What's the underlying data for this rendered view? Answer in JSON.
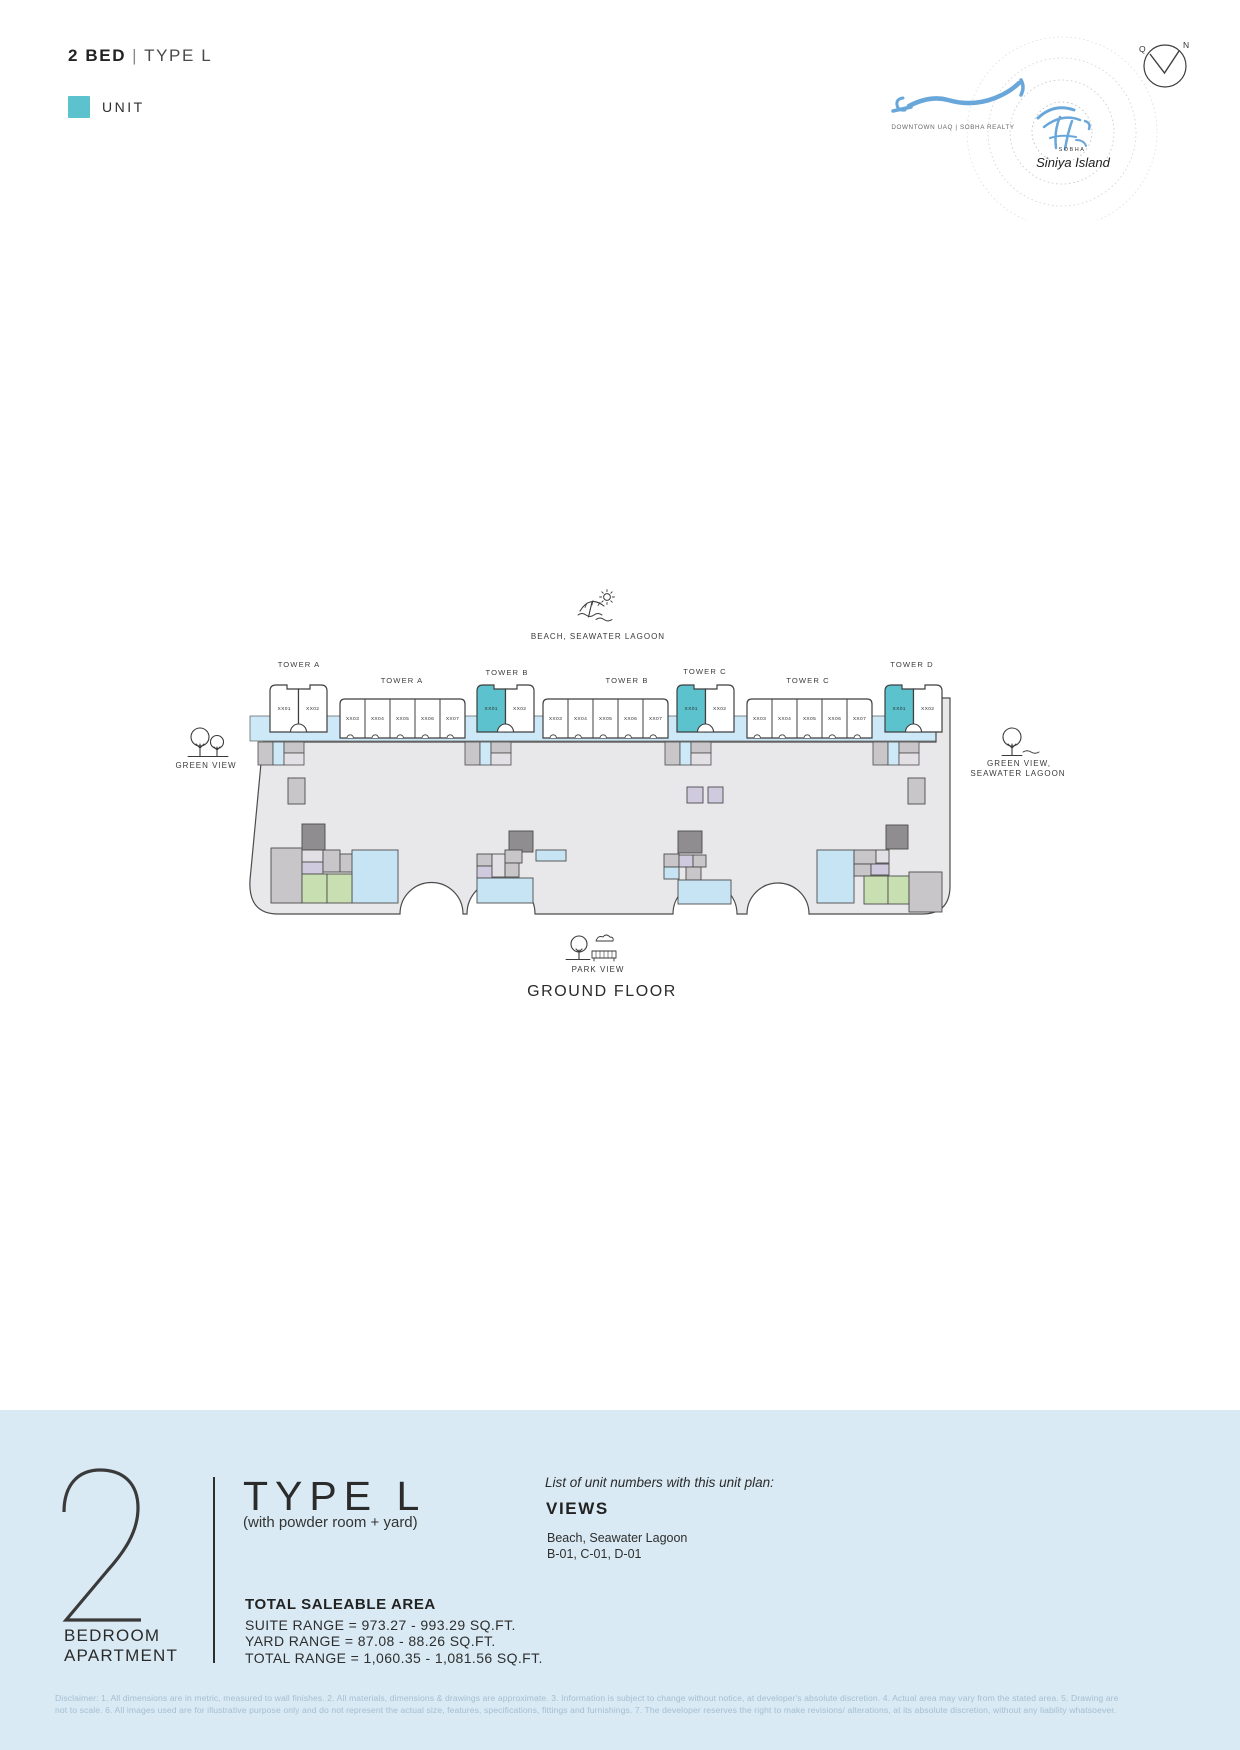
{
  "header": {
    "title_bold": "2 BED",
    "separator": "|",
    "title_rest": "TYPE L",
    "legend": {
      "label": "UNIT"
    }
  },
  "logo": {
    "location_line": "DOWNTOWN UAQ | SOBHA REALTY",
    "brand": "SOBHA",
    "brand_script": "Siniya Island",
    "compass_left": "Q",
    "compass_right": "N"
  },
  "plan": {
    "beach_label": "BEACH, SEAWATER LAGOON",
    "left_view_label": "GREEN VIEW",
    "right_view_label_line1": "GREEN VIEW,",
    "right_view_label_line2": "SEAWATER LAGOON",
    "park_label": "PARK VIEW",
    "floor_label": "GROUND FLOOR",
    "towers": [
      {
        "label_pair": "TOWER A",
        "pair": [
          {
            "id": "XX01",
            "highlight": false
          },
          {
            "id": "XX02",
            "highlight": false
          }
        ],
        "label_block": "TOWER A",
        "block_units": [
          "XX03",
          "XX04",
          "XX05",
          "XX06",
          "XX07"
        ]
      },
      {
        "label_pair": "TOWER B",
        "pair": [
          {
            "id": "XX01",
            "highlight": true
          },
          {
            "id": "XX02",
            "highlight": false
          }
        ],
        "label_block": "TOWER B",
        "block_units": [
          "XX03",
          "XX04",
          "XX05",
          "XX06",
          "XX07"
        ]
      },
      {
        "label_pair": "TOWER C",
        "pair": [
          {
            "id": "XX01",
            "highlight": true
          },
          {
            "id": "XX02",
            "highlight": false
          }
        ],
        "label_block": "TOWER C",
        "block_units": [
          "XX03",
          "XX04",
          "XX05",
          "XX06",
          "XX07"
        ]
      },
      {
        "label_pair": "TOWER D",
        "pair": [
          {
            "id": "XX01",
            "highlight": true
          },
          {
            "id": "XX02",
            "highlight": false
          }
        ]
      }
    ]
  },
  "info": {
    "number": "2",
    "number_caption_line1": "BEDROOM",
    "number_caption_line2": "APARTMENT",
    "type_title": "TYPE L",
    "type_subtitle": "(with powder room + yard)",
    "area_heading": "TOTAL SALEABLE AREA",
    "area_lines": [
      "SUITE RANGE = 973.27 - 993.29 SQ.FT.",
      "YARD RANGE = 87.08 - 88.26 SQ.FT.",
      "TOTAL RANGE = 1,060.35 - 1,081.56 SQ.FT."
    ],
    "units_list_intro": "List of unit numbers with this unit plan:",
    "views_heading": "VIEWS",
    "views_value": "Beach,  Seawater Lagoon",
    "units_value": "B-01, C-01, D-01"
  },
  "colors": {
    "unit_highlight": "#5cc2cd",
    "strip_blue": "#cde8f6",
    "pool_blue": "#c7e4f4",
    "green": "#c8dfb2",
    "lavender": "#cfcadd",
    "podium_gray": "#e8e7e9",
    "band_blue": "#d9eaf4",
    "logo_blue": "#69a7da"
  },
  "disclaimer": {
    "line1": "Disclaimer: 1. All dimensions are in metric, measured to wall finishes. 2. All materials, dimensions & drawings are approximate. 3. Information is subject to change without notice, at developer's absolute discretion. 4. Actual area may vary from the stated area. 5. Drawing are",
    "line2": "not to scale. 6. All images used are for illustrative purpose only and do not represent the actual size, features, specifications, fittings and furnishings. 7. The developer reserves the right to make revisions/ alterations, at its absolute discretion, without any liability whatsoever."
  }
}
